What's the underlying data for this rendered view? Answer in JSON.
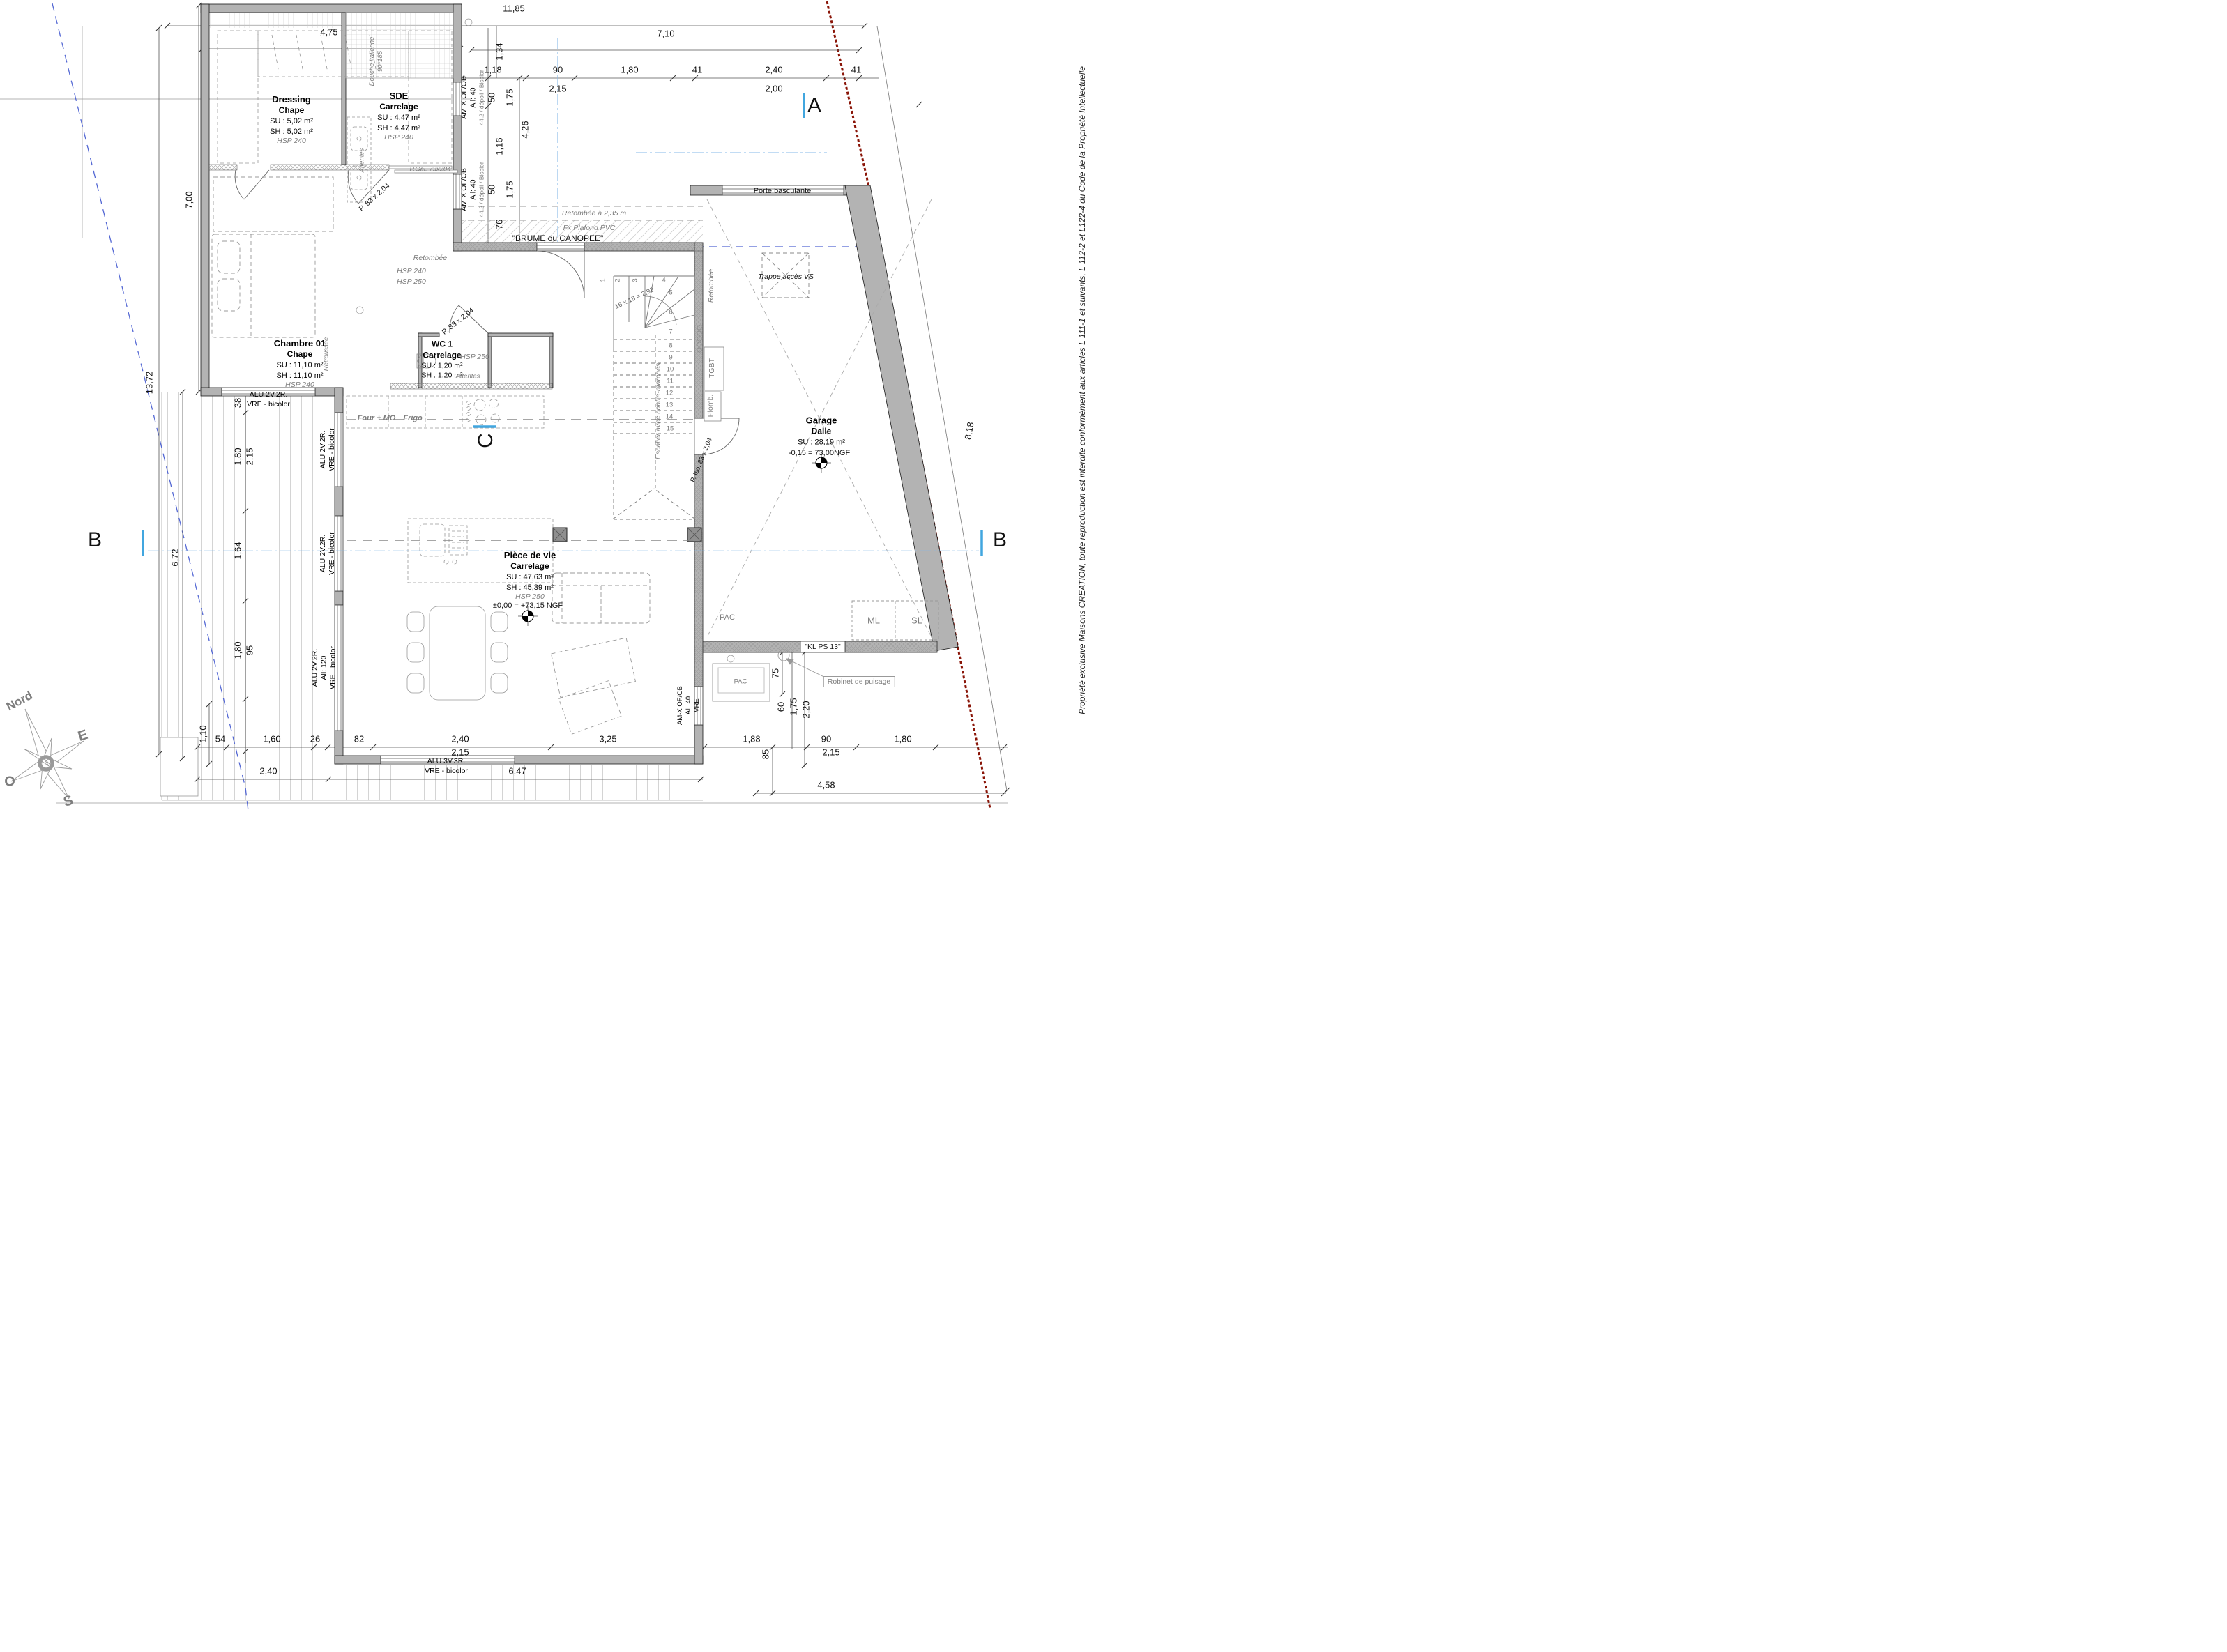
{
  "copyright": "Propriété exclusive Maisons CREATION, toute reproduction est interdite conformément aux articles L 111-1 et suivants, L 112-2 et L122-4 du Code de la Propriété Intellectuelle",
  "compass": {
    "n": "Nord",
    "e": "E",
    "o": "O",
    "s": "S"
  },
  "sections": {
    "a": "A",
    "b_left": "B",
    "b_right": "B",
    "c": "C"
  },
  "rooms": {
    "dressing": {
      "name": "Dressing",
      "floor": "Chape",
      "su": "SU : 5,02 m²",
      "sh": "SH : 5,02 m²",
      "hsp": "HSP 240"
    },
    "sde": {
      "name": "SDE",
      "floor": "Carrelage",
      "su": "SU : 4,47 m²",
      "sh": "SH : 4,47 m²",
      "hsp": "HSP 240",
      "shower1": "Douche italienne",
      "shower2": "90*185",
      "attentes": "Attentes"
    },
    "chambre": {
      "name": "Chambre 01",
      "floor": "Chape",
      "su": "SU : 11,10 m²",
      "sh": "SH : 11,10 m²",
      "hsp": "HSP 240",
      "note": "Retroussée"
    },
    "wc": {
      "name": "WC 1",
      "floor": "Carrelage",
      "su": "SU : 1,20 m²",
      "sh": "SH : 1,20 m²",
      "hsp": "HSP 250",
      "attentes": "Attentes"
    },
    "sejour": {
      "name": "Pièce de vie",
      "floor": "Carrelage",
      "su": "SU : 47,63 m²",
      "sh": "SH : 45,39 m²",
      "hsp": "HSP 250",
      "level": "±0,00 = +73,15 NGF"
    },
    "garage": {
      "name": "Garage",
      "floor": "Dalle",
      "su": "SU : 28,19 m²",
      "level": "-0,15 = 73,00NGF"
    }
  },
  "labels": {
    "porte_basculante": "Porte basculante",
    "trappe": "Trappe accès VS",
    "retombee235": "Retombée à 2,35 m",
    "fx_plafond": "Fx Plafond PVC",
    "brume": "\"BRUME ou CANOPEE\"",
    "retombee_h": "Retombée",
    "retombee_v": "Retombée",
    "hsp240": "HSP 240",
    "hsp250": "HSP 250",
    "four": "Four + MO",
    "frigo": "Frigo",
    "tgbt": "TGBT",
    "plomb": "Plomb.",
    "pac_int": "PAC",
    "pac_ext": "PAC",
    "ml": "ML",
    "sl": "SL",
    "klps": "\"KL PS 13\"",
    "robinet": "Robinet de puisage",
    "p_gal": "P.Gal. 73x204",
    "p83_hall": "P. 83 x 2,04",
    "p83_wc": "P. 83 x 2,04",
    "p_iso": "P. Iso. 83 x 2,04"
  },
  "windows": {
    "amx1_l1": "AM-X OF/OB",
    "amx1_l2": "All: 40",
    "amx1_l3": "44.2 / dépoli / Bicolor",
    "amx2_l1": "AM-X OF/OB",
    "amx2_l2": "All: 40",
    "amx2_l3": "44.2 / dépoli / Bicolor",
    "amx3_l1": "AM-X OF/OB",
    "amx3_l2": "All: 40",
    "amx3_l3": "VRE",
    "alu_ch_l1": "ALU 2V.2R.",
    "alu_ch_l2": "VRE - bicolor",
    "alu_s1_l1": "ALU 2V.2R.",
    "alu_s1_l2": "VRE - bicolor",
    "alu_s2_l1": "ALU 2V.2R.",
    "alu_s2_l2": "VRE - bicolor",
    "alu_s3_l1": "ALU 2V.2R.",
    "alu_s3_l2": "All: 120",
    "alu_s3_l3": "VRE - bicolor",
    "alu_b_l1": "ALU 3V.3R.",
    "alu_b_l2": "VRE - bicolor"
  },
  "stairs": {
    "steps": [
      "1",
      "2",
      "3",
      "4",
      "5",
      "6",
      "7",
      "8",
      "9",
      "10",
      "11",
      "12",
      "13",
      "14",
      "15"
    ],
    "formula": "16 x 18 = 2,92",
    "note": "Escalier avec contre-marches"
  },
  "dims": {
    "top": [
      "11,85",
      "7,10",
      "4,75"
    ],
    "toprow": [
      "1,18",
      "90",
      "1,80",
      "41",
      "2,40",
      "41"
    ],
    "toprow2": [
      "2,15",
      "2,00"
    ],
    "topv": [
      "1,34",
      "50",
      "1,75",
      "4,26",
      "1,16",
      "50",
      "1,75",
      "76"
    ],
    "left": [
      "7,00",
      "13,72",
      "6,72"
    ],
    "leftchain": [
      "38",
      "1,80",
      "2,15",
      "1,64",
      "1,80",
      "95"
    ],
    "bottom": [
      "1,10",
      "54",
      "1,60",
      "26",
      "82",
      "2,40",
      "2,15",
      "3,25",
      "1,88",
      "85",
      "90",
      "2,15",
      "1,80"
    ],
    "bottom2": [
      "2,40",
      "6,47",
      "4,58"
    ],
    "right": [
      "60",
      "1,75",
      "2,20",
      "75"
    ],
    "slope": [
      "8,18"
    ]
  }
}
